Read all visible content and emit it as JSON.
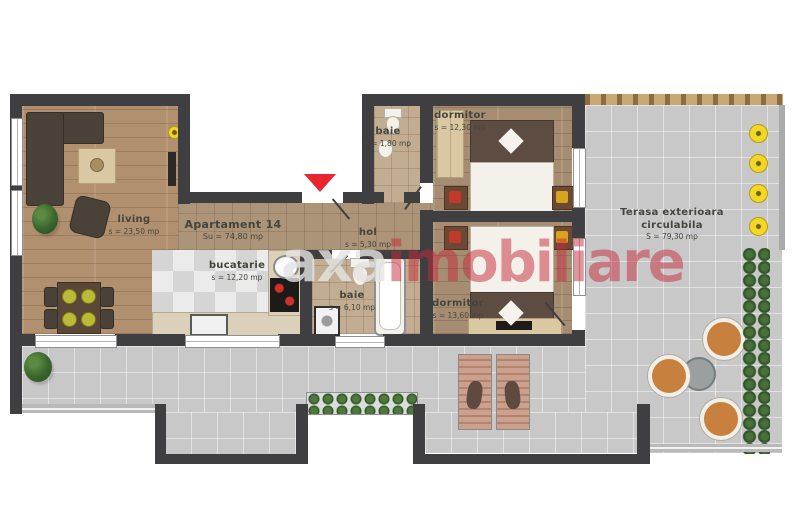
{
  "apartment": {
    "name": "Apartament 14",
    "area": "Su = 74,80 mp"
  },
  "rooms": {
    "living": {
      "label": "living",
      "area": "s = 23,50 mp"
    },
    "kitchen": {
      "label": "bucatarie",
      "area": "s = 12,20 mp"
    },
    "hall": {
      "label": "hol",
      "area": "s = 5,30 mp"
    },
    "bath_small": {
      "label": "baie",
      "area": "s = 1,80 mp"
    },
    "bath": {
      "label": "baie",
      "area": "s = 6,10 mp"
    },
    "bedroom1": {
      "label": "dormitor",
      "area": "s = 12,30 mp"
    },
    "bedroom2": {
      "label": "dormitor",
      "area": "s = 13,60 mp"
    }
  },
  "terrace": {
    "line1": "Terasa exterioara",
    "line2": "circulabila",
    "area": "S = 79,30 mp"
  },
  "watermark": {
    "brand": "axa",
    "suffix": "imobiliare"
  },
  "colors": {
    "entrance_arrow": "#e8262d",
    "watermark_red": "#c52a3a",
    "wall": "#3f3f41",
    "terrace_gray": "#c8c8c8",
    "wood": "#b19070",
    "light_yellow": "#f2d726"
  }
}
